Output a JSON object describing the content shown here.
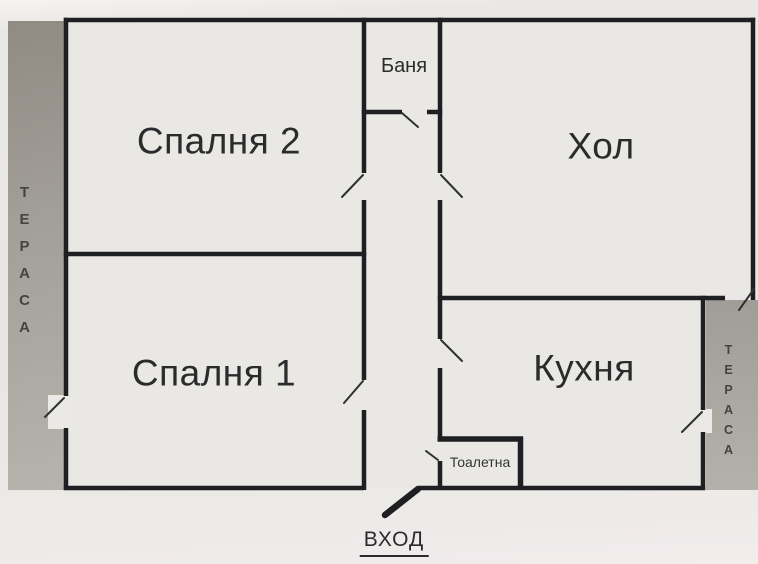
{
  "document": {
    "type": "apartment-floor-plan"
  },
  "rooms": {
    "bedroom2": {
      "label": "Спалня 2"
    },
    "hall": {
      "label": "Хол"
    },
    "bathroom": {
      "label": "Баня"
    },
    "bedroom1": {
      "label": "Спалня 1"
    },
    "kitchen": {
      "label": "Кухня"
    },
    "toilet": {
      "label": "Тоалетна"
    }
  },
  "terraces": {
    "left": {
      "label": "ТЕРАСА"
    },
    "right": {
      "label": "ТЕРАСА"
    }
  },
  "entrance": {
    "label": "ВХОД"
  },
  "colors": {
    "wall": "#1e1f22",
    "paper": "#e9e7e4",
    "room_fill": "#eae8e4",
    "terrace_gray": "#a5a19b",
    "door_line": "#2f3035",
    "text": "#2a2b2d"
  }
}
